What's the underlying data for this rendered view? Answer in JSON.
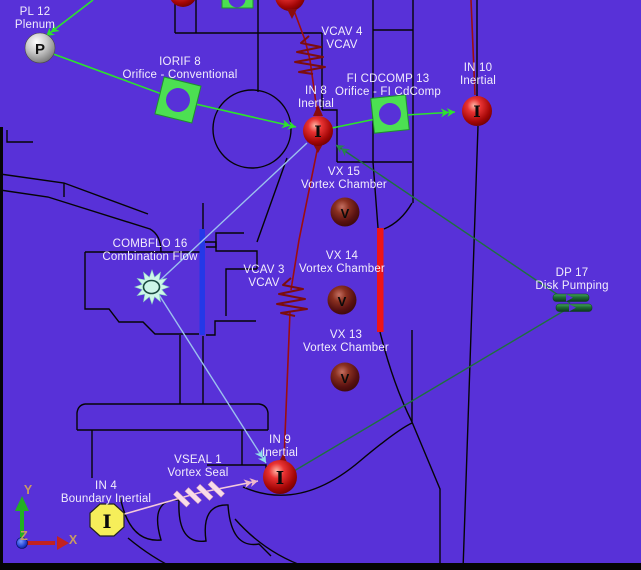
{
  "diagram": {
    "title": "Secondary Flow Network Model",
    "background": "#5831d8",
    "labels": {
      "pl12": {
        "name": "PL 12",
        "desc": "Plenum"
      },
      "iorif8": {
        "name": "IORIF 8",
        "desc": "Orifice - Conventional"
      },
      "vcav4": {
        "name": "VCAV 4",
        "desc": "VCAV"
      },
      "ficdcomp13": {
        "name": "FI CDCOMP 13",
        "desc": "Orifice - FI CdComp"
      },
      "in8": {
        "name": "IN 8",
        "desc": "Inertial"
      },
      "in10": {
        "name": "IN 10",
        "desc": "Inertial"
      },
      "vx15": {
        "name": "VX 15",
        "desc": "Vortex Chamber"
      },
      "vx14": {
        "name": "VX 14",
        "desc": "Vortex Chamber"
      },
      "vx13": {
        "name": "VX 13",
        "desc": "Vortex Chamber"
      },
      "combflo16": {
        "name": "COMBFLO 16",
        "desc": "Combination Flow"
      },
      "vcav3": {
        "name": "VCAV 3",
        "desc": "VCAV"
      },
      "dp17": {
        "name": "DP 17",
        "desc": "Disk Pumping"
      },
      "in9": {
        "name": "IN 9",
        "desc": "Inertial"
      },
      "vseal1": {
        "name": "VSEAL 1",
        "desc": "Vortex Seal"
      },
      "in4": {
        "name": "IN 4",
        "desc": "Boundary Inertial"
      }
    },
    "glyphs": {
      "plenum": "P",
      "inertial": "I",
      "vortex": "V"
    },
    "axes": {
      "x": "X",
      "y": "Y",
      "z": "Z"
    },
    "colors": {
      "background": "#5831d8",
      "geometry": "#050505",
      "flow_green": "#2de22d",
      "flow_dark_green": "#1f7040",
      "flow_cyan": "#9cc0ee",
      "flow_pink": "#f4cada",
      "flow_dark_red": "#9c0e0e",
      "red_marker_bar": "#ee1515",
      "blue_marker_bar": "#2438e8",
      "axis_label": "#c89a64"
    }
  }
}
